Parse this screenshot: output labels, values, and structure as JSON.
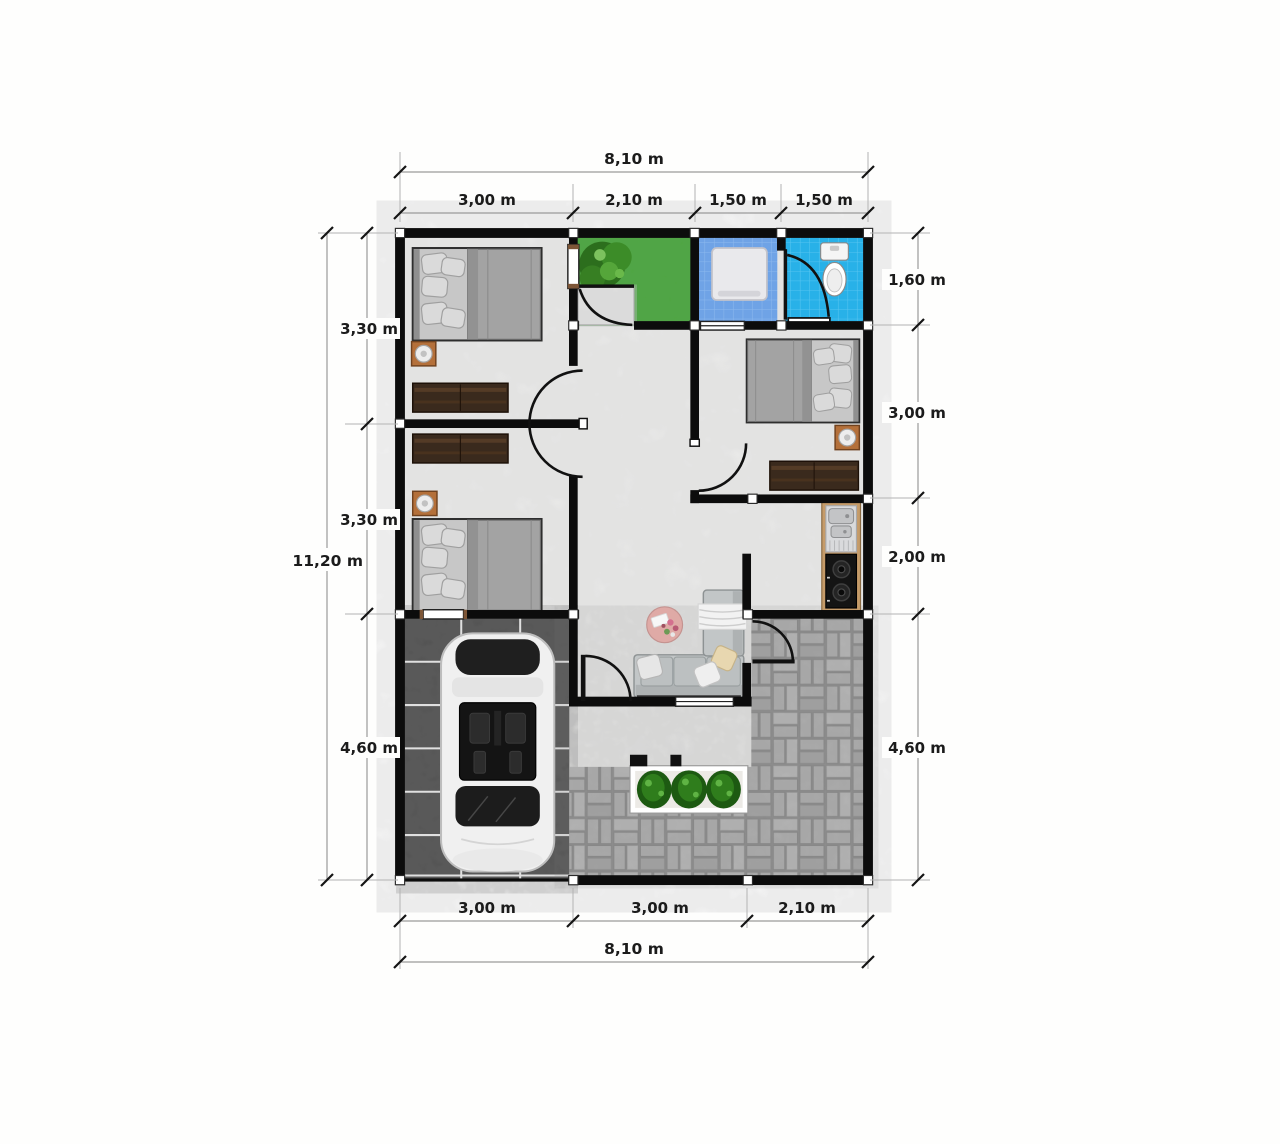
{
  "title": "House floor plan 8,10 x 11,20 m",
  "dimensions": {
    "top": {
      "overall": "8,10 m",
      "segments": [
        "3,00 m",
        "2,10 m",
        "1,50 m",
        "1,50 m"
      ]
    },
    "bottom": {
      "overall": "8,10 m",
      "segments": [
        "3,00 m",
        "3,00 m",
        "2,10 m"
      ]
    },
    "left": {
      "overall": "11,20 m",
      "segments": [
        "3,30 m",
        "3,30 m",
        "4,60 m"
      ]
    },
    "right": {
      "segments": [
        "1,60 m",
        "3,00 m",
        "2,00 m",
        "4,60 m"
      ]
    }
  },
  "colors": {
    "wall": "#0c0c0c",
    "marble": "#f1f1ef",
    "grass": "#47a53a",
    "bath_blue": "#6fa3e6",
    "bath_cyan": "#28b1e8",
    "carport_tile": "#4e4e4e",
    "paver": "#adadad",
    "counter_wood": "#c59b69",
    "wardrobe": "#3a2a1d",
    "nightstand": "#b4703a",
    "bed": "#c7c7c7",
    "sofa": "#c2c6c7",
    "coffee_table": "#dfaaa6",
    "planter_green": "#2f7d1c",
    "dim_line": "#9a9a9a",
    "dim_text": "#1b1b1b"
  }
}
